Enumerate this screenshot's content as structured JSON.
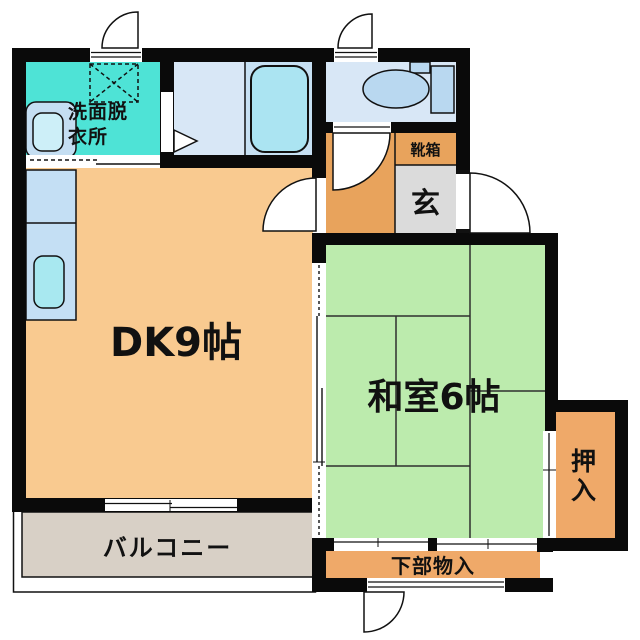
{
  "rooms": {
    "washroom": {
      "label": "洗面脱衣所",
      "color": "#4ee3d6"
    },
    "bathroom": {
      "color": "#d8e7f6",
      "tub_area_color": "#c6e0f3"
    },
    "toilet_room": {
      "color": "#d8e7f6"
    },
    "hallway": {
      "color": "#e8a35c"
    },
    "shoe_box": {
      "label": "靴箱",
      "color": "#e8a35c"
    },
    "entrance": {
      "label": "玄",
      "color": "#dbdbdb"
    },
    "dining_kitchen": {
      "label": "DK9帖",
      "color": "#f9ca90"
    },
    "japanese_room": {
      "label": "和室6帖",
      "color": "#bcebad"
    },
    "closet": {
      "label": "押入",
      "color": "#efa969"
    },
    "under_storage": {
      "label": "下部物入",
      "color": "#efa969"
    },
    "balcony": {
      "label": "バルコニー",
      "color": "#d8d0c6"
    }
  },
  "fixtures": {
    "bathtub_color": "#abe4f2",
    "toilet_color": "#b9d8f0",
    "kitchen_sink_color": "#a8e8f0",
    "basin_color": "#c4def2",
    "basin_bowl_color": "#cdeff8",
    "counter_color": "#c4dff4"
  },
  "wall_color": "#0a0a0a"
}
